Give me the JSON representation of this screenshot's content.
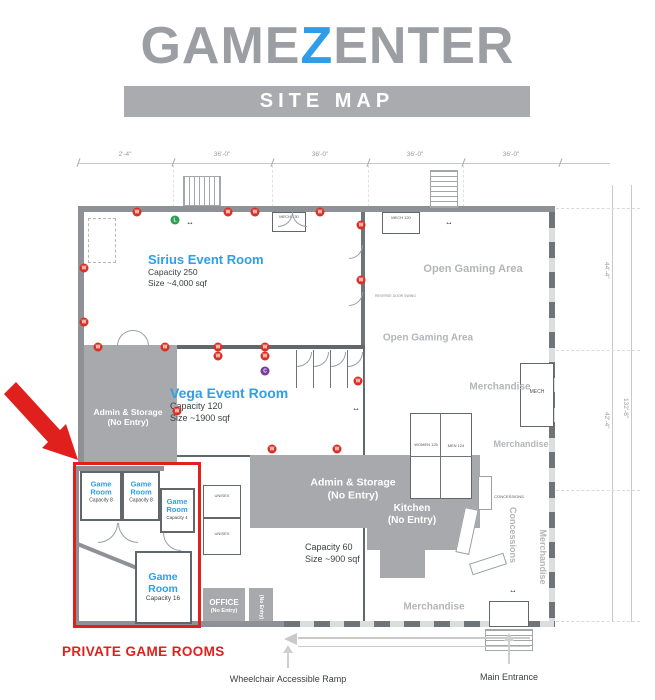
{
  "logo": {
    "part1": "GAME",
    "z": "Z",
    "part2": "ENTER",
    "banner": "SITE MAP"
  },
  "colors": {
    "accent_blue": "#2e9fe8",
    "logo_gray": "#9b9ea3",
    "banner_gray": "#a9abae",
    "zone_gray": "#a7a9ac",
    "wall_gray": "#8e9296",
    "area_label_gray": "#b3b5b8",
    "highlight_red": "#e0201c",
    "marker_red": "#d93025",
    "marker_green": "#2f9e4f",
    "marker_purple": "#7a3a9b"
  },
  "rooms": {
    "sirius": {
      "title": "Sirius Event Room",
      "capacity": "Capacity 250",
      "size": "Size ~4,000 sqf"
    },
    "vega": {
      "title": "Vega Event Room",
      "capacity": "Capacity 120",
      "size": "Size ~1900 sqf"
    },
    "open_gaming_upper": "Open Gaming Area",
    "open_gaming_lower": "Open Gaming Area",
    "admin_left": {
      "line1": "Admin & Storage",
      "line2": "(No Entry)"
    },
    "admin_center": {
      "line1": "Admin & Storage",
      "line2": "(No Entry)"
    },
    "kitchen": {
      "line1": "Kitchen",
      "line2": "(No Entry)"
    },
    "kitchen_area": {
      "capacity": "Capacity 60",
      "size": "Size ~900 sqf"
    },
    "office": {
      "line1": "OFFICE",
      "line2": "(No Entry)"
    },
    "mech_corridor": "(No Entry)",
    "game_room_small_1": {
      "title": "Game Room",
      "capacity": "Capacity 8"
    },
    "game_room_small_2": {
      "title": "Game Room",
      "capacity": "Capacity 8"
    },
    "game_room_small_3": {
      "title": "Game Room",
      "capacity": "Capacity 4"
    },
    "game_room_large": {
      "title": "Game Room",
      "capacity": "Capacity 16"
    },
    "merchandise_upper": "Merchandise",
    "merchandise_mid": "Merchandise",
    "merchandise_lower": "Merchandise",
    "merchandise_vertical": "Merchandise",
    "concessions_vertical": "Concessions",
    "concessions_counter": "CONCESSIONS",
    "mech_top_left": "MECH 130",
    "mech_top_right": "MECH 120",
    "mech_right": "MECH",
    "unisex_upper": "UNISEX",
    "unisex_lower": "UNISEX",
    "women": "WOMEN 125",
    "men": "MEN 124",
    "reverse_door_note": "REVERSE DOOR SWING"
  },
  "annotations": {
    "private_game_rooms": "PRIVATE GAME ROOMS",
    "wheelchair_ramp": "Wheelchair Accessible Ramp",
    "main_entrance": "Main Entrance"
  },
  "dimensions": {
    "top": [
      "2'-4\"",
      "36'-0\"",
      "36'-0\"",
      "36'-0\"",
      "36'-0\""
    ],
    "right_upper": "44'-4\"",
    "right_lower": "42'-4\"",
    "right_total": "132'-8\""
  },
  "markers": [
    {
      "x": 137,
      "y": 212,
      "label": "W",
      "type": "w"
    },
    {
      "x": 228,
      "y": 212,
      "label": "W",
      "type": "w"
    },
    {
      "x": 255,
      "y": 212,
      "label": "W",
      "type": "w"
    },
    {
      "x": 320,
      "y": 212,
      "label": "W",
      "type": "w"
    },
    {
      "x": 361,
      "y": 225,
      "label": "W",
      "type": "w"
    },
    {
      "x": 361,
      "y": 280,
      "label": "W",
      "type": "w"
    },
    {
      "x": 84,
      "y": 268,
      "label": "W",
      "type": "w"
    },
    {
      "x": 84,
      "y": 322,
      "label": "W",
      "type": "w"
    },
    {
      "x": 98,
      "y": 347,
      "label": "W",
      "type": "w"
    },
    {
      "x": 165,
      "y": 347,
      "label": "W",
      "type": "w"
    },
    {
      "x": 218,
      "y": 347,
      "label": "W",
      "type": "w"
    },
    {
      "x": 218,
      "y": 356,
      "label": "W",
      "type": "w"
    },
    {
      "x": 265,
      "y": 347,
      "label": "W",
      "type": "w"
    },
    {
      "x": 265,
      "y": 356,
      "label": "W",
      "type": "w"
    },
    {
      "x": 177,
      "y": 411,
      "label": "W",
      "type": "w"
    },
    {
      "x": 358,
      "y": 381,
      "label": "W",
      "type": "w"
    },
    {
      "x": 272,
      "y": 449,
      "label": "W",
      "type": "w"
    },
    {
      "x": 337,
      "y": 449,
      "label": "W",
      "type": "w"
    },
    {
      "x": 175,
      "y": 220,
      "label": "L",
      "type": "l"
    },
    {
      "x": 265,
      "y": 371,
      "label": "C",
      "type": "c"
    },
    {
      "x": 190,
      "y": 222,
      "label": "↔",
      "type": "h"
    },
    {
      "x": 449,
      "y": 222,
      "label": "↔",
      "type": "h"
    },
    {
      "x": 356,
      "y": 408,
      "label": "↔",
      "type": "h"
    },
    {
      "x": 513,
      "y": 590,
      "label": "↔",
      "type": "h"
    }
  ]
}
